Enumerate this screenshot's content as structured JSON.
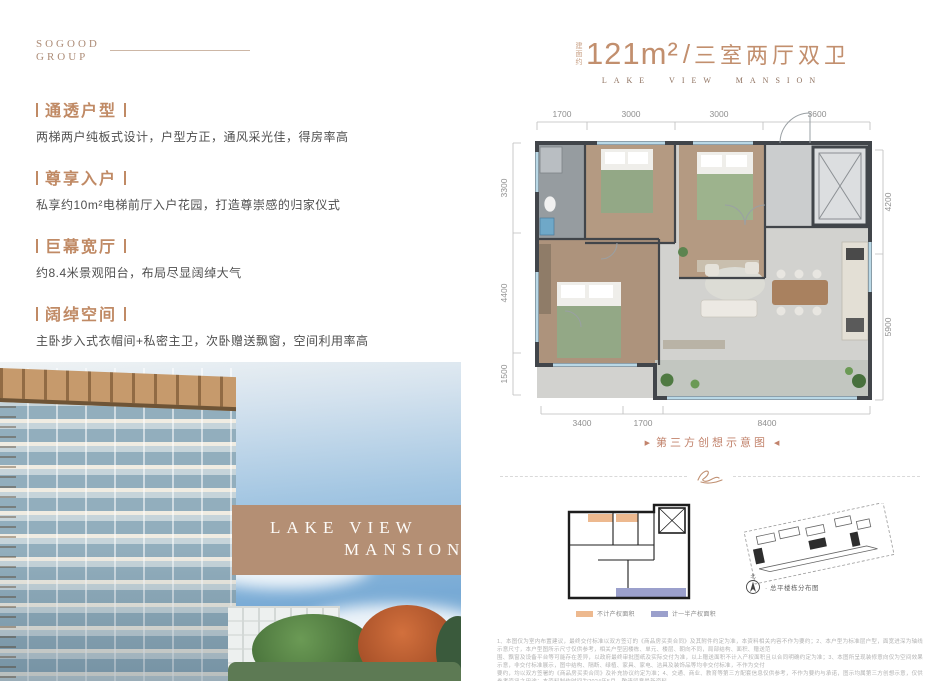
{
  "logo": {
    "line1": "SOGOOD",
    "line2": "GROUP"
  },
  "features": [
    {
      "title": "通透户型",
      "desc": "两梯两户纯板式设计，户型方正，通风采光佳，得房率高"
    },
    {
      "title": "尊享入户",
      "desc": "私享约10m²电梯前厅入户花园，打造尊崇感的归家仪式"
    },
    {
      "title": "巨幕宽厅",
      "desc": "约8.4米景观阳台，布局尽显阔绰大气"
    },
    {
      "title": "阔绰空间",
      "desc": "主卧步入式衣帽间+私密主卫，次卧赠送飘窗，空间利用率高"
    }
  ],
  "photo": {
    "overlay_line1": "LAKE VIEW",
    "overlay_line2": "MANSION"
  },
  "plan": {
    "area_prefix": "建面约",
    "area": "121m²",
    "separator": "/",
    "layout": "三室两厅双卫",
    "subtitle": "LAKE VIEW MANSION",
    "dims_top": [
      "1700",
      "3000",
      "3000",
      "3600"
    ],
    "dims_left": [
      "3300",
      "4400",
      "1500"
    ],
    "dims_right": [
      "4200",
      "5900"
    ],
    "dims_bottom": [
      "3400",
      "1700",
      "8400"
    ],
    "caption": "第三方创想示意图",
    "caption_prefix": "▶",
    "caption_suffix": "◀"
  },
  "legend": {
    "items": [
      {
        "color": "#edb98f",
        "label": "不计产权面积"
      },
      {
        "color": "#9ba0cc",
        "label": "计一半产权面积"
      }
    ]
  },
  "siteplan": {
    "compass_label": "北",
    "label": "· 总平楼栋分布图"
  },
  "disclaimer": {
    "lines": [
      "1、本图仅为室内布置建议，最终交付标准以双方签订的《商品房买卖合同》及其附件约定为准，本资料相关内容不作为要约；2、本户型为标准层户型，面宽进深为轴线示意尺寸，本户型图所示尺寸仅供参考，相关户型因楼栋、单元、楼层、朝向不同，局部结构、面积、赠送范",
      "围、飘窗及设备平台等可能存在差异，以政府最终审批图纸及实际交付为准，以上赠送面积不计入产权面积且以合同明确约定为准；3、本图所呈现装修意向仅为空间效果示意，非交付标准展示，图中结构、隔断、绿植、家具、家电、洁具及装饰品等均非交付标准，不作为交付",
      "要约，均以双方签署的《商品房买卖合同》及补充协议约定为准；4、交通、商业、教育等第三方配套信息仅供参考，不作为要约与承诺，图示均属第三方创想示意，仅供参考资讯之用途；本资料制作时间为2024年5月，敬请留意最新资料。"
    ]
  }
}
